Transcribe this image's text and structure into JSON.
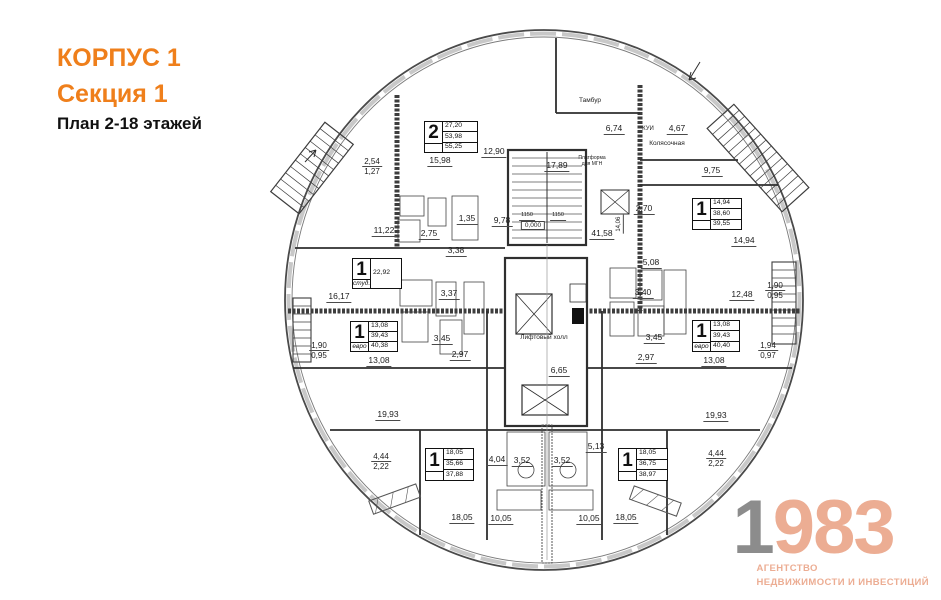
{
  "header": {
    "korpus": "КОРПУС 1",
    "section": "Секция 1",
    "plan_title": "План 2-18 этажей"
  },
  "logo": {
    "digit_gray": "1",
    "digits_accent": "983",
    "tagline1": "АГЕНТСТВО",
    "tagline2": "НЕДВИЖИМОСТИ И ИНВЕСТИЦИЙ"
  },
  "colors": {
    "accent_orange": "#EF7F1B",
    "logo_salmon": "#ECAD93",
    "logo_gray": "#8C8C8C",
    "line_dark": "#2f2f2f"
  },
  "apartments": [
    {
      "type": "2",
      "subtype": "",
      "values": [
        "27,20",
        "53,98",
        "55,25"
      ],
      "x": 424,
      "y": 121,
      "w": 52,
      "h": 30
    },
    {
      "type": "1",
      "subtype": "",
      "values": [
        "14,94",
        "38,60",
        "39,55"
      ],
      "x": 692,
      "y": 198,
      "w": 48,
      "h": 30
    },
    {
      "type": "1",
      "subtype": "студ.",
      "values": [
        "22,92"
      ],
      "x": 352,
      "y": 258,
      "w": 48,
      "h": 29
    },
    {
      "type": "1",
      "subtype": "евро",
      "values": [
        "13,08",
        "39,43",
        "40,38"
      ],
      "x": 350,
      "y": 321,
      "w": 46,
      "h": 29
    },
    {
      "type": "1",
      "subtype": "евро",
      "values": [
        "13,08",
        "39,43",
        "40,40"
      ],
      "x": 692,
      "y": 320,
      "w": 46,
      "h": 30
    },
    {
      "type": "1",
      "subtype": "",
      "values": [
        "18,05",
        "35,66",
        "37,88"
      ],
      "x": 425,
      "y": 448,
      "w": 47,
      "h": 31
    },
    {
      "type": "1",
      "subtype": "",
      "values": [
        "18,05",
        "36,75",
        "38,97"
      ],
      "x": 618,
      "y": 448,
      "w": 48,
      "h": 31
    }
  ],
  "dimensions": [
    {
      "t": "15,98",
      "x": 440,
      "y": 156
    },
    {
      "t": "12,90",
      "x": 494,
      "y": 147
    },
    {
      "t": "17,89",
      "x": 557,
      "y": 161
    },
    {
      "t": "6,74",
      "x": 614,
      "y": 124
    },
    {
      "t": "4,67",
      "x": 677,
      "y": 124
    },
    {
      "t": "9,75",
      "x": 712,
      "y": 166
    },
    {
      "t": "2,70",
      "x": 644,
      "y": 204
    },
    {
      "t": "14,94",
      "x": 744,
      "y": 236
    },
    {
      "t": "11,22",
      "x": 384,
      "y": 226
    },
    {
      "t": "2,75",
      "x": 429,
      "y": 229
    },
    {
      "t": "1,35",
      "x": 467,
      "y": 214
    },
    {
      "t": "9,78",
      "x": 502,
      "y": 216
    },
    {
      "t": "41,58",
      "x": 602,
      "y": 229
    },
    {
      "t": "14,06",
      "x": 620,
      "y": 220,
      "rot": true,
      "fs": 6
    },
    {
      "t": "1150",
      "x": 527,
      "y": 213,
      "fs": 5.5
    },
    {
      "t": "1150",
      "x": 558,
      "y": 213,
      "fs": 5.5
    },
    {
      "t": "3,38",
      "x": 456,
      "y": 246
    },
    {
      "t": "16,17",
      "x": 339,
      "y": 292
    },
    {
      "t": "3,37",
      "x": 449,
      "y": 289
    },
    {
      "t": "5,08",
      "x": 651,
      "y": 258
    },
    {
      "t": "3,40",
      "x": 643,
      "y": 288
    },
    {
      "t": "12,48",
      "x": 742,
      "y": 290
    },
    {
      "t": "3,45",
      "x": 442,
      "y": 334
    },
    {
      "t": "3,45",
      "x": 654,
      "y": 333
    },
    {
      "t": "2,97",
      "x": 460,
      "y": 350
    },
    {
      "t": "2,97",
      "x": 646,
      "y": 353
    },
    {
      "t": "13,08",
      "x": 379,
      "y": 356
    },
    {
      "t": "13,08",
      "x": 714,
      "y": 356
    },
    {
      "t": "6,65",
      "x": 559,
      "y": 366
    },
    {
      "t": "19,93",
      "x": 388,
      "y": 410
    },
    {
      "t": "19,93",
      "x": 716,
      "y": 411
    },
    {
      "t": "5,13",
      "x": 596,
      "y": 442
    },
    {
      "t": "4,04",
      "x": 497,
      "y": 455
    },
    {
      "t": "3,52",
      "x": 522,
      "y": 456
    },
    {
      "t": "3,52",
      "x": 562,
      "y": 456
    },
    {
      "t": "18,05",
      "x": 462,
      "y": 513
    },
    {
      "t": "10,05",
      "x": 501,
      "y": 514
    },
    {
      "t": "10,05",
      "x": 589,
      "y": 514
    },
    {
      "t": "18,05",
      "x": 626,
      "y": 513
    }
  ],
  "stacked_dimensions": [
    {
      "top": "2,54",
      "bot": "1,27",
      "x": 372,
      "y": 157
    },
    {
      "top": "1,90",
      "bot": "0,95",
      "x": 319,
      "y": 341
    },
    {
      "top": "1,90",
      "bot": "0,95",
      "x": 775,
      "y": 281
    },
    {
      "top": "1,94",
      "bot": "0,97",
      "x": 768,
      "y": 341
    },
    {
      "top": "4,44",
      "bot": "2,22",
      "x": 381,
      "y": 452
    },
    {
      "top": "4,44",
      "bot": "2,22",
      "x": 716,
      "y": 449
    }
  ],
  "room_labels": [
    {
      "t": "Тамбур",
      "x": 590,
      "y": 97
    },
    {
      "t": "КУИ",
      "x": 648,
      "y": 126,
      "fs": 6
    },
    {
      "t": "Колясочная",
      "x": 667,
      "y": 140
    },
    {
      "t": "Платформа для МГН",
      "x": 592,
      "y": 156,
      "wrap": true,
      "w": 36
    },
    {
      "t": "0,000",
      "x": 533,
      "y": 221,
      "boxed": true
    },
    {
      "t": "Лифтовый холл",
      "x": 544,
      "y": 334
    }
  ]
}
